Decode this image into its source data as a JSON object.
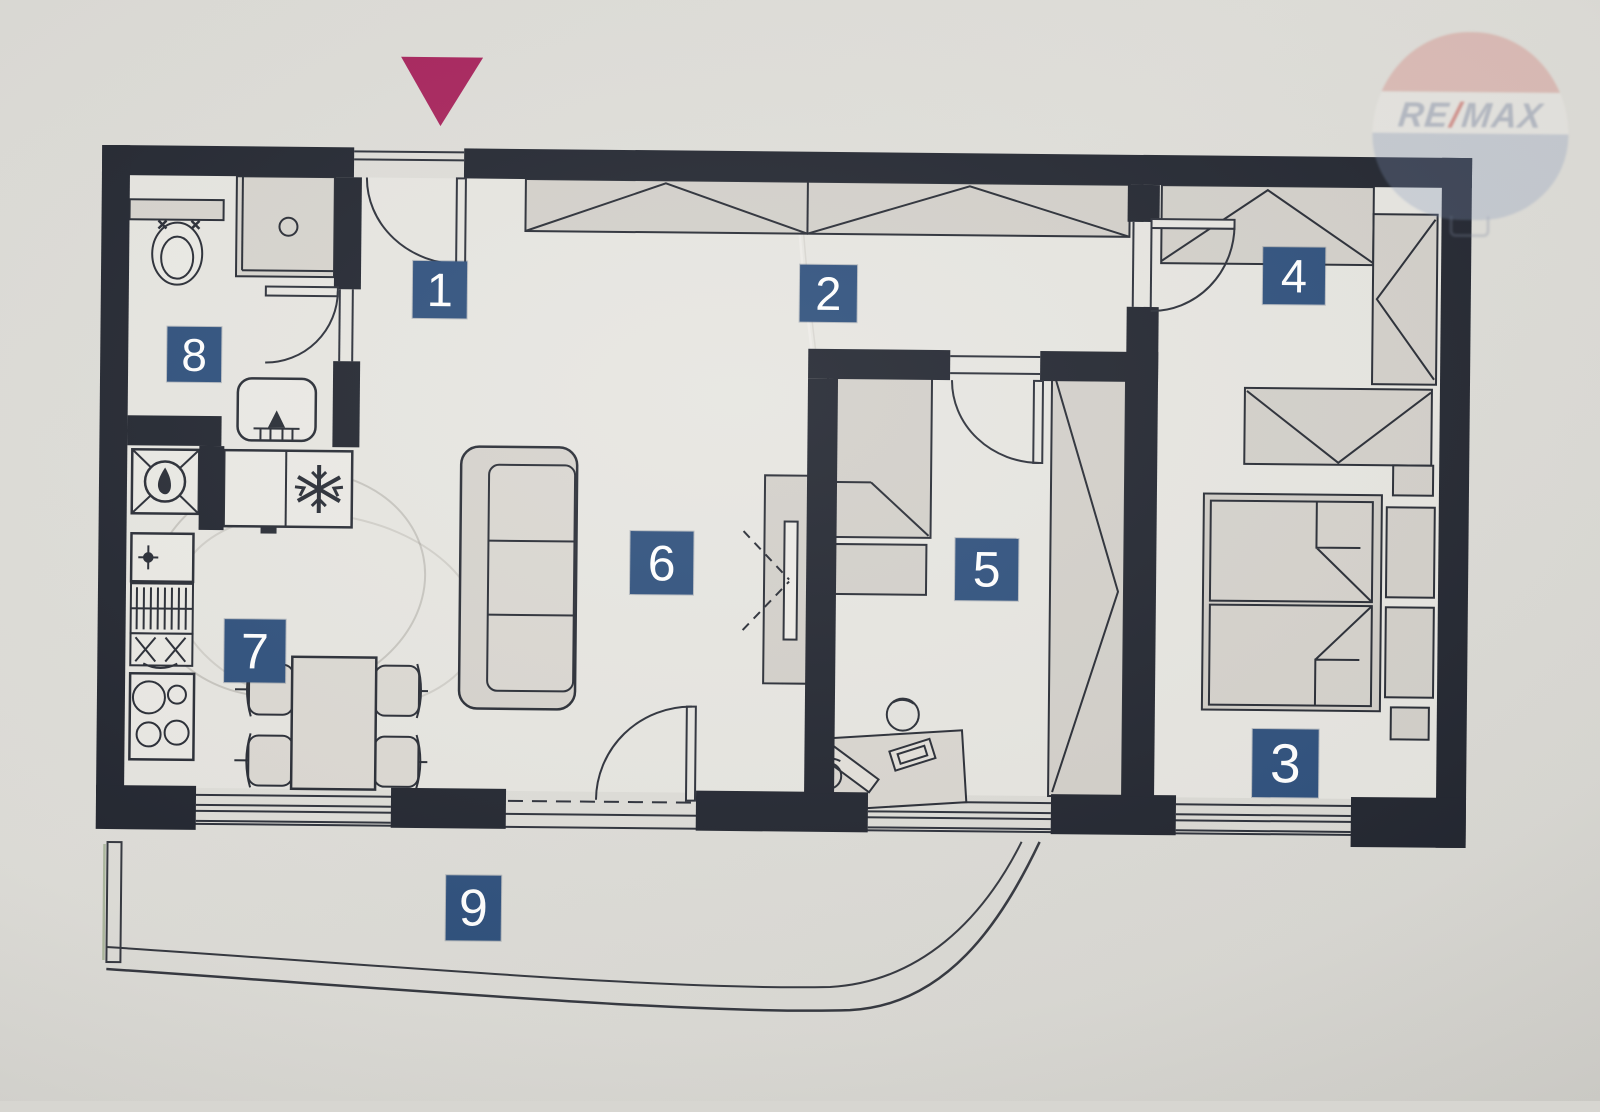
{
  "rooms": [
    {
      "number": "1"
    },
    {
      "number": "2"
    },
    {
      "number": "3"
    },
    {
      "number": "4"
    },
    {
      "number": "5"
    },
    {
      "number": "6"
    },
    {
      "number": "7"
    },
    {
      "number": "8"
    },
    {
      "number": "9"
    }
  ],
  "watermark": {
    "re": "RE",
    "slash": "/",
    "max": "MAX"
  },
  "colors": {
    "badge_bg": "#2c4e7b",
    "badge_text": "#ffffff",
    "entrance_marker": "#a6215a",
    "wall": "#20242e",
    "floor": "#e6e5e0",
    "furniture": "#d3d0ca"
  }
}
